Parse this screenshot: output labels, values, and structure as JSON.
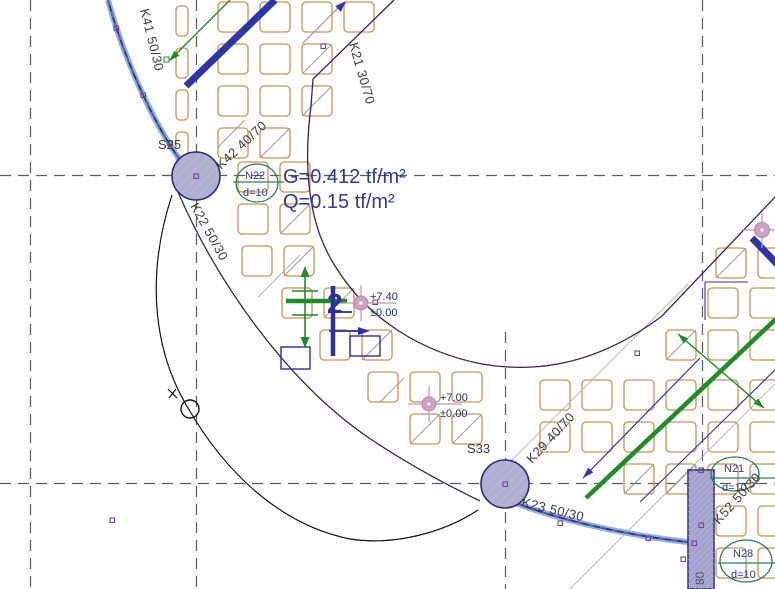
{
  "drawing": {
    "type_note": "structural-slab-plan",
    "beams": {
      "k41": "K41 50/30",
      "k21": "K21 30/70",
      "k42": "K42 40/70",
      "k22": "K22 50/30",
      "k23": "K23 50/30",
      "k29": "K29 40/70",
      "k52": "K52 50/30"
    },
    "columns": {
      "s25": "S25",
      "s33": "S33",
      "wall": "80"
    },
    "rebar_tags": {
      "n22": {
        "id": "N22",
        "dia": "d=10"
      },
      "n21": {
        "id": "N21",
        "dia": "d=10"
      },
      "n28": {
        "id": "N28",
        "dia": "d=10"
      }
    },
    "loads": {
      "g": "G=0.412 tf/m²",
      "q": "Q=0.15 tf/m²"
    },
    "levels": {
      "upper": {
        "elev": "+7.40",
        "ref": "±0.00"
      },
      "lower": {
        "elev": "+7.00",
        "ref": "±0.00"
      }
    },
    "section_marker": {
      "number": "2"
    },
    "colors": {
      "block_orange": "#c9924e",
      "grid_gray": "#5a5a5a",
      "edge_purple": "#3f2060",
      "band_blue": "#8fb3e0",
      "beam_navy": "#2d35a8",
      "green": "#1e8c28",
      "tag_teal": "#2e7d64",
      "load_text_blue": "#2b3a9e",
      "level_text_navy": "#1d2e6e",
      "column_fill": "#aeaed6",
      "column_stroke": "#2a2a7a",
      "pink_marker": "#cf9fc4",
      "vertex_purple": "#7b3fa0"
    }
  }
}
